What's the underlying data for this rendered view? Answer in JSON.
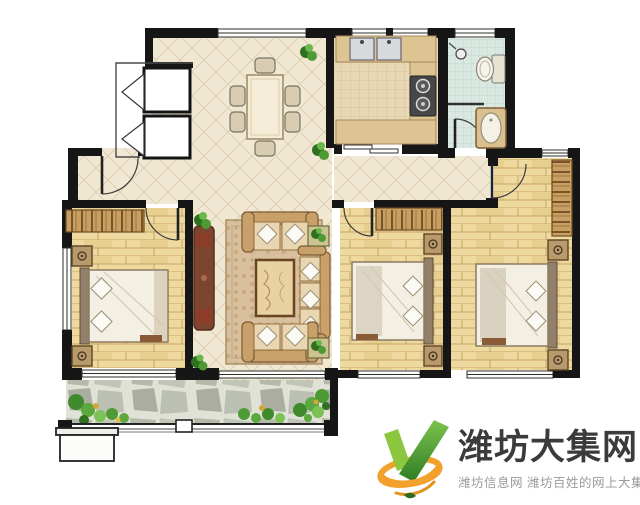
{
  "watermark": {
    "title": "潍坊大集网",
    "subtitle": "潍坊信息网 潍坊百姓的网上大集",
    "colors": {
      "title": "#3b3b3b",
      "subtitle": "#9b9b9b",
      "logo_green_light": "#8cc63e",
      "logo_green_dark": "#2e7d22",
      "logo_orange": "#f2a12d"
    }
  },
  "floor_plan": {
    "palette": {
      "wall": "#161616",
      "diamond_tile_floor": "#f1e8d3",
      "wood_floor": "#eeda9f",
      "kitchen_floor": "#e9d8b6",
      "bathroom_floor": "#dae8e2",
      "counter": "#dcc493",
      "balcony_stone": "#b6bbab",
      "plant_green": "#4e9438",
      "sofa_tan": "#d7b488",
      "tv_cabinet_brown": "#7d452f"
    }
  }
}
